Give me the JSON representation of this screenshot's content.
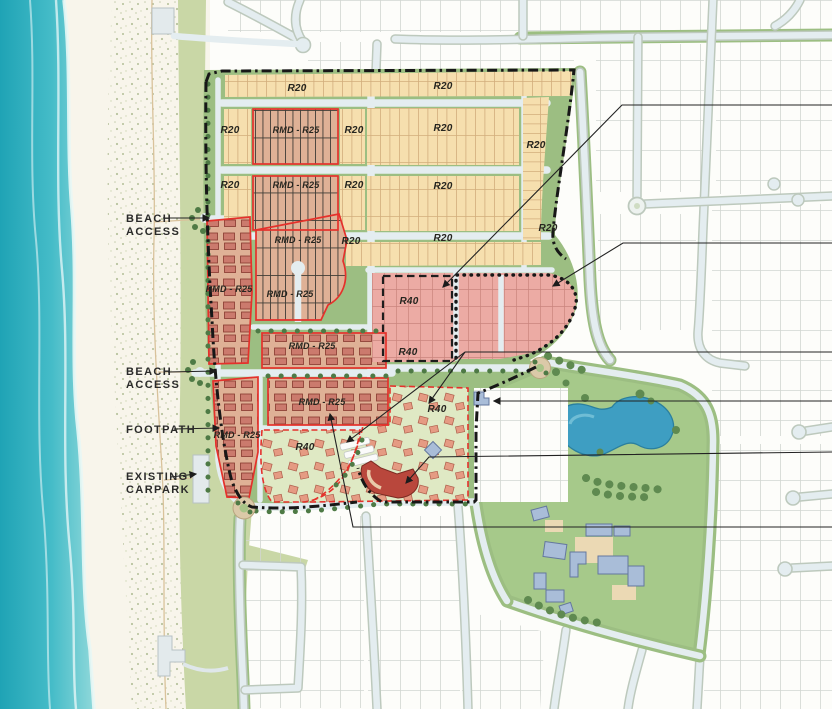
{
  "map": {
    "side_labels": [
      {
        "id": "beach-access-1",
        "lines": [
          "BEACH",
          "ACCESS"
        ],
        "x": 126,
        "y": 222,
        "line_height": 13
      },
      {
        "id": "beach-access-2",
        "lines": [
          "BEACH",
          "ACCESS"
        ],
        "x": 126,
        "y": 375,
        "line_height": 13
      },
      {
        "id": "footpath",
        "lines": [
          "FOOTPATH"
        ],
        "x": 126,
        "y": 433,
        "line_height": 13
      },
      {
        "id": "existing-carpark",
        "lines": [
          "EXISTING",
          "CARPARK"
        ],
        "x": 126,
        "y": 480,
        "line_height": 13
      }
    ],
    "zone_labels": [
      {
        "text": "R20",
        "x": 297,
        "y": 91
      },
      {
        "text": "R20",
        "x": 443,
        "y": 89
      },
      {
        "text": "R20",
        "x": 230,
        "y": 133
      },
      {
        "text": "RMD - R25",
        "x": 296,
        "y": 133
      },
      {
        "text": "R20",
        "x": 354,
        "y": 133
      },
      {
        "text": "R20",
        "x": 443,
        "y": 131
      },
      {
        "text": "R20",
        "x": 536,
        "y": 148
      },
      {
        "text": "R20",
        "x": 230,
        "y": 188
      },
      {
        "text": "RMD - R25",
        "x": 296,
        "y": 188
      },
      {
        "text": "R20",
        "x": 354,
        "y": 188
      },
      {
        "text": "R20",
        "x": 443,
        "y": 189
      },
      {
        "text": "R20",
        "x": 548,
        "y": 231
      },
      {
        "text": "RMD - R25",
        "x": 298,
        "y": 243
      },
      {
        "text": "R20",
        "x": 351,
        "y": 244
      },
      {
        "text": "R20",
        "x": 443,
        "y": 241
      },
      {
        "text": "RMD - R25",
        "x": 229,
        "y": 292
      },
      {
        "text": "RMD - R25",
        "x": 290,
        "y": 297
      },
      {
        "text": "R40",
        "x": 409,
        "y": 304
      },
      {
        "text": "R40",
        "x": 408,
        "y": 355
      },
      {
        "text": "RMD - R25",
        "x": 312,
        "y": 349
      },
      {
        "text": "RMD - R25",
        "x": 322,
        "y": 405
      },
      {
        "text": "R40",
        "x": 305,
        "y": 450
      },
      {
        "text": "R40",
        "x": 437,
        "y": 412
      },
      {
        "text": "RMD - R25",
        "x": 237,
        "y": 438
      }
    ],
    "colors": {
      "ocean_deep": "#1fa3b5",
      "ocean_mid": "#45bcc8",
      "ocean_shore": "#8fd8da",
      "sand": "#f8f5eb",
      "dune_speckle": "#a3b183",
      "reserve_green": "#c9d7a6",
      "park_green": "#a6c98a",
      "lake_blue": "#3e9ec2",
      "road": "#e4edf0",
      "road_casing": "#bdc9bd",
      "verge_green": "#9cbe82",
      "r20_cream": "#f6dfae",
      "r20_lotline": "#d2ad7c",
      "rmd_salmon": "#dfb196",
      "unit_roof": "#cb7a6d",
      "unit_edge": "#86382e",
      "r40_pink": "#ecaba4",
      "r40_lotline": "#c9847d",
      "village_green": "#dfe9c4",
      "house_roof": "#e59b83",
      "house_edge": "#ad5c49",
      "red_outline": "#e5312b",
      "bldg_red": "#b9473c",
      "bldg_blue": "#a9bdd8",
      "bldg_blue_edge": "#64789e",
      "boundary": "#171717",
      "lot_gray": "#d2d6d1",
      "label": "#2a2a2a",
      "roundabout_tan": "#dbc9a8",
      "tree_dark": "#4e7a45",
      "tree_park": "#5f8a50"
    }
  }
}
